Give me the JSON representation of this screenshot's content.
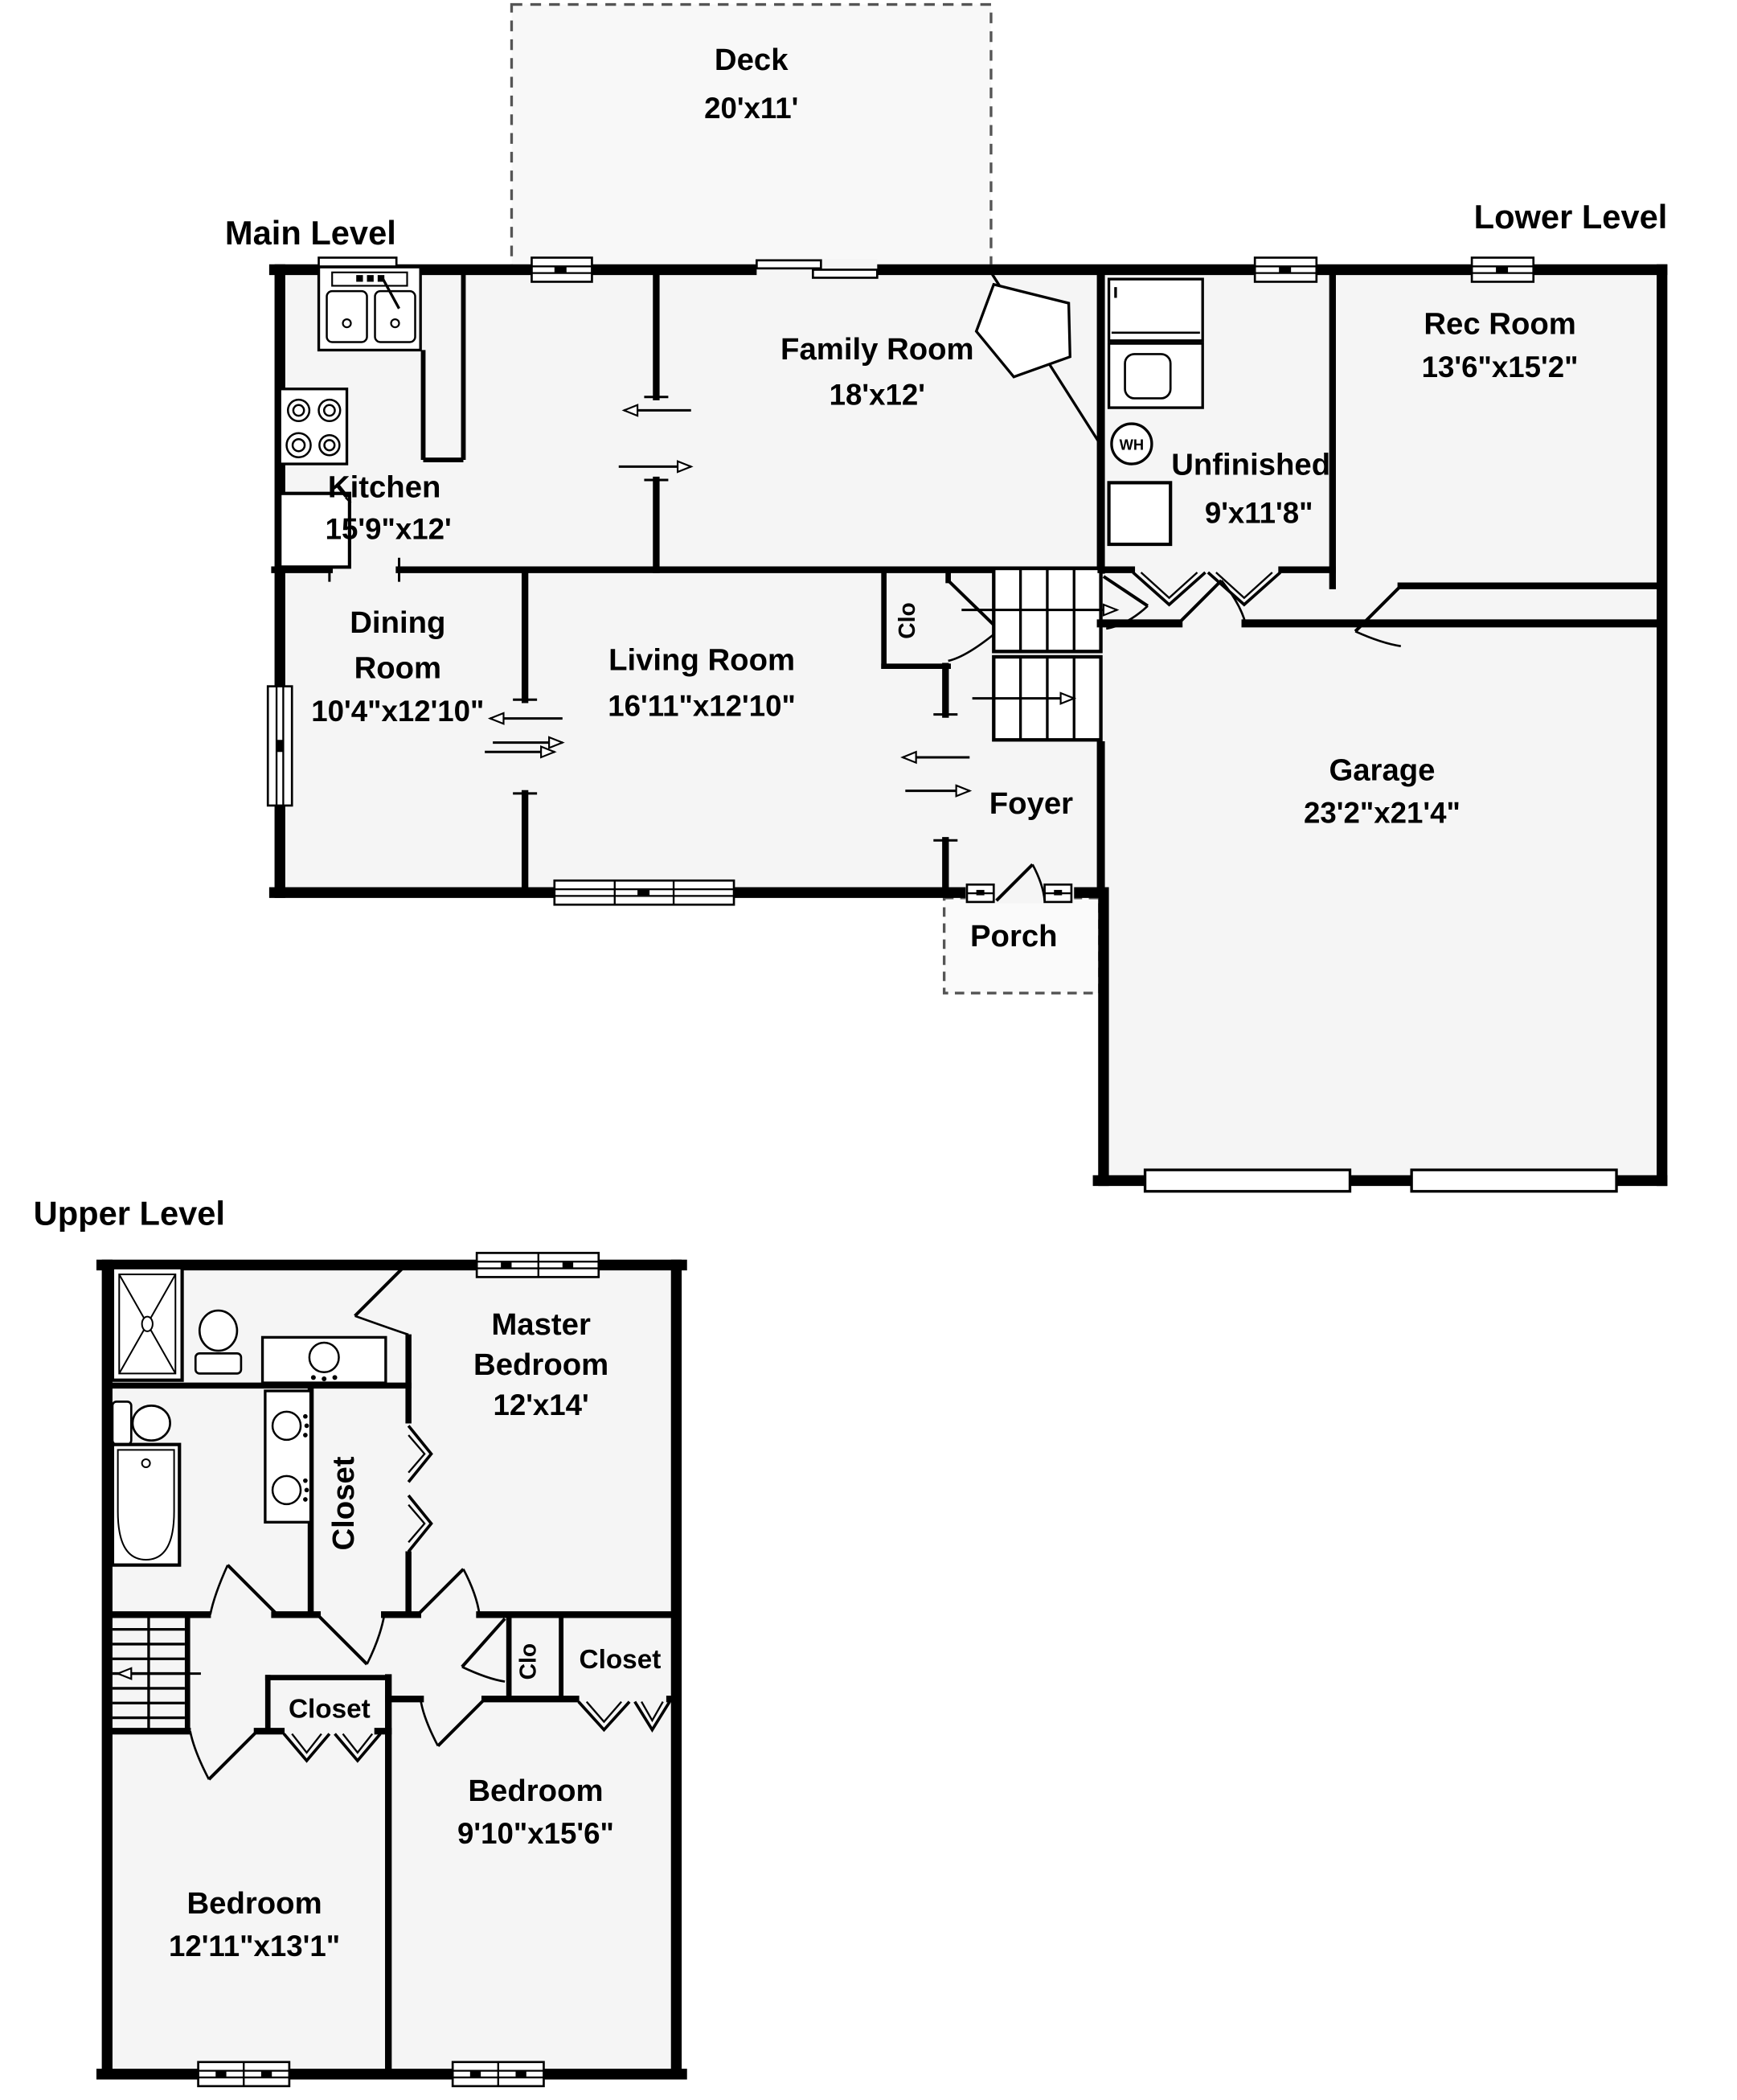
{
  "page": {
    "background": "#ffffff",
    "wall_color": "#000000",
    "room_fill": "#f5f5f5",
    "deck_fill": "#f8f8f8"
  },
  "titles": {
    "main": "Main Level",
    "lower": "Lower Level",
    "upper": "Upper Level"
  },
  "main_level": {
    "deck": {
      "name": "Deck",
      "dims": "20'x11'"
    },
    "kitchen": {
      "name": "Kitchen",
      "dims": "15'9\"x12'"
    },
    "family_room": {
      "name": "Family Room",
      "dims": "18'x12'"
    },
    "dining_room": {
      "name_line1": "Dining",
      "name_line2": "Room",
      "dims": "10'4\"x12'10\""
    },
    "living_room": {
      "name": "Living Room",
      "dims": "16'11\"x12'10\""
    },
    "hall_closet": {
      "name": "Clo"
    },
    "foyer": {
      "name": "Foyer"
    },
    "porch": {
      "name": "Porch"
    }
  },
  "lower_level": {
    "rec_room": {
      "name": "Rec Room",
      "dims": "13'6\"x15'2\""
    },
    "unfinished": {
      "name": "Unfinished",
      "dims": "9'x11'8\""
    },
    "garage": {
      "name": "Garage",
      "dims": "23'2\"x21'4\""
    },
    "water_heater": {
      "label": "WH"
    }
  },
  "upper_level": {
    "master_bedroom": {
      "name_line1": "Master",
      "name_line2": "Bedroom",
      "dims": "12'x14'"
    },
    "master_closet": {
      "name": "Closet"
    },
    "bedroom2": {
      "name": "Bedroom",
      "dims": "9'10\"x15'6\""
    },
    "bedroom2_clo": {
      "name": "Clo"
    },
    "bedroom2_closet": {
      "name": "Closet"
    },
    "bedroom3": {
      "name": "Bedroom",
      "dims": "12'11\"x13'1\""
    },
    "bedroom3_closet": {
      "name": "Closet"
    }
  }
}
